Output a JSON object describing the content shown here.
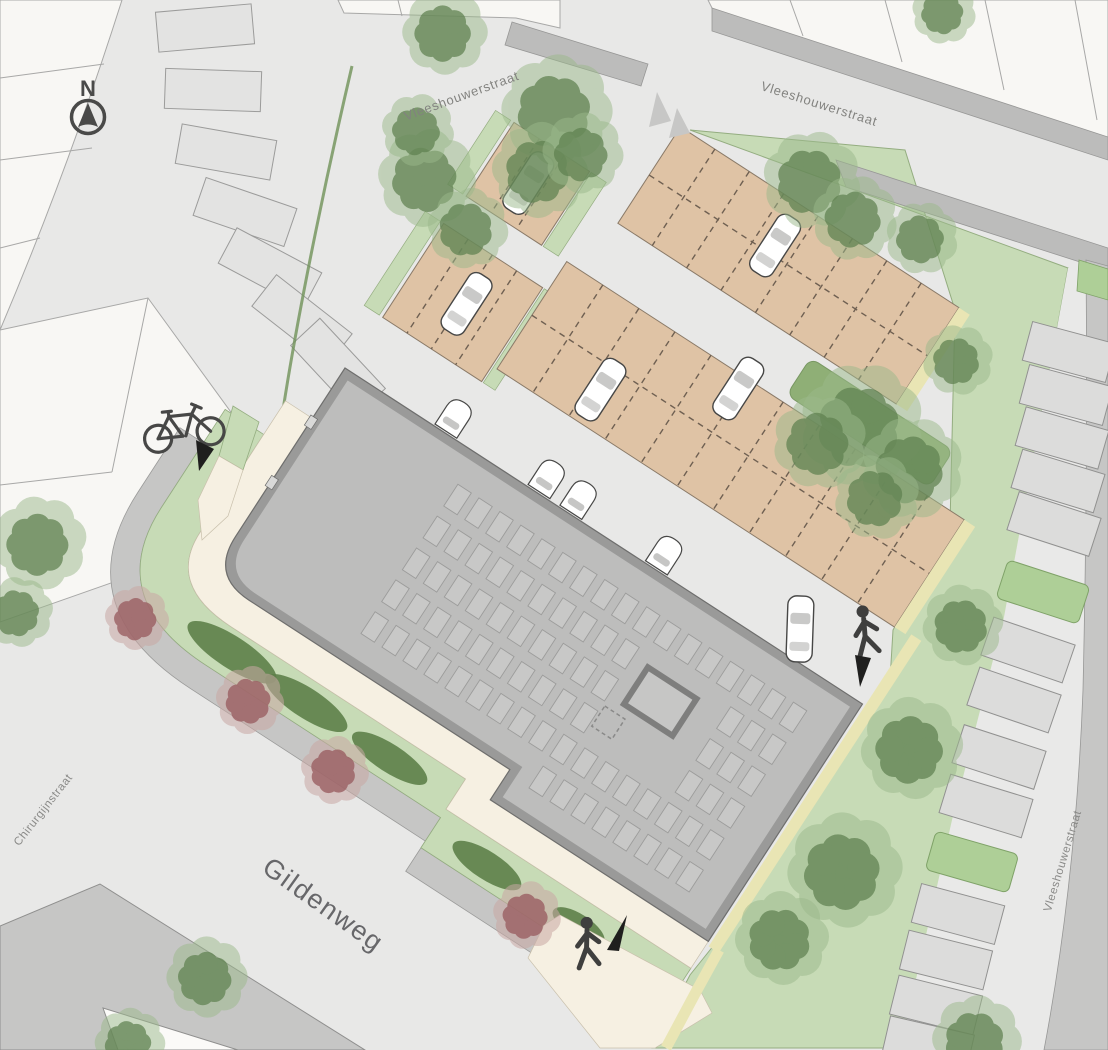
{
  "map": {
    "title": "site-plan",
    "compass_label": "N",
    "streets": {
      "top_center": "Vleeshouwerstraat",
      "top_right": "Vleeshouwerstraat",
      "right_edge": "Vleeshouw­erstraat",
      "southwest": "Gildenweg",
      "west": "Chirurgijnstraat"
    },
    "icons": [
      "compass-north-icon",
      "bicycle-icon",
      "pedestrian-icon",
      "direction-arrow-icon",
      "yield-marking-icon"
    ],
    "colors": {
      "road": "#e8e8e7",
      "parcel": "#f8f7f4",
      "sidewalk": "#c6c6c5",
      "street_band": "#bcbcbb",
      "building_wall": "#9a9a99",
      "building_roof": "#bdbdbc",
      "solar_panel": "#c8c8c7",
      "parking_tan": "#dfc3a5",
      "path_cream": "#f6f0e2",
      "edge_yellow": "#e9e5b4",
      "green_area": "#c7dbb6",
      "tree_green": "#5f8150",
      "tree_red": "#9e6165",
      "lawn": "#5d8049",
      "icon_dark": "#3f3f3e",
      "car_body": "#ffffff"
    }
  }
}
